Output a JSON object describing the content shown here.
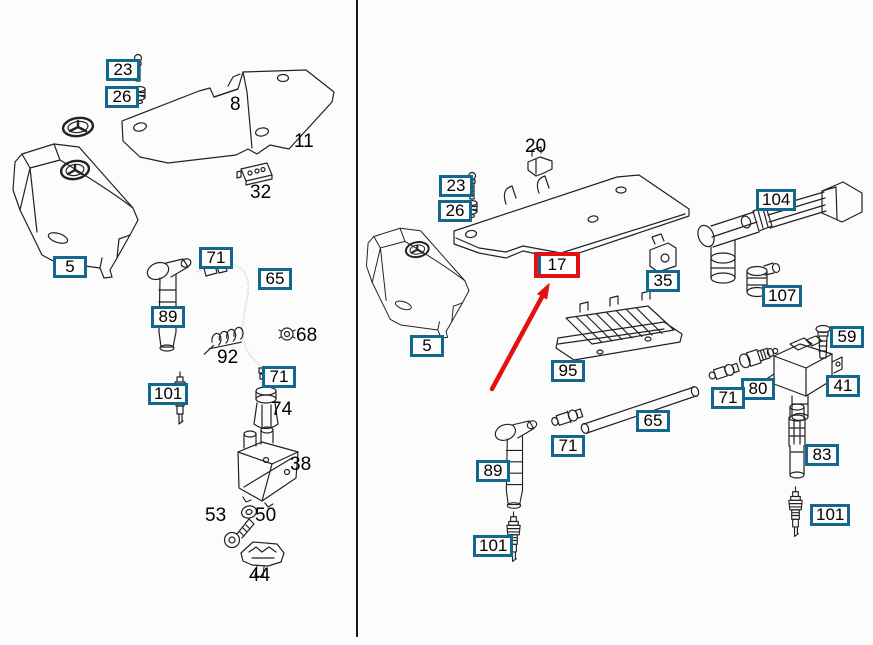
{
  "colors": {
    "page_bg": "#fcfcfc",
    "box_border": "#12688f",
    "highlight_border": "#e31212",
    "arrow": "#e31212",
    "ink": "#222222",
    "divider": "#1a1a1a"
  },
  "diagram": {
    "kind": "engine-ignition-parts-diagram",
    "highlighted_part": "17",
    "panel_count": 2
  },
  "labels_left": [
    {
      "text": "23",
      "style": "boxed"
    },
    {
      "text": "26",
      "style": "boxed"
    },
    {
      "text": "8",
      "style": "plain"
    },
    {
      "text": "11",
      "style": "plain"
    },
    {
      "text": "32",
      "style": "plain"
    },
    {
      "text": "5",
      "style": "boxed"
    },
    {
      "text": "71",
      "style": "boxed"
    },
    {
      "text": "65",
      "style": "boxed"
    },
    {
      "text": "89",
      "style": "boxed"
    },
    {
      "text": "92",
      "style": "plain"
    },
    {
      "text": "68",
      "style": "plain"
    },
    {
      "text": "71",
      "style": "boxed"
    },
    {
      "text": "101",
      "style": "boxed"
    },
    {
      "text": "74",
      "style": "plain"
    },
    {
      "text": "38",
      "style": "plain"
    },
    {
      "text": "53",
      "style": "plain"
    },
    {
      "text": "50",
      "style": "plain"
    },
    {
      "text": "44",
      "style": "plain"
    }
  ],
  "labels_right": [
    {
      "text": "20",
      "style": "plain"
    },
    {
      "text": "23",
      "style": "boxed"
    },
    {
      "text": "26",
      "style": "boxed"
    },
    {
      "text": "17",
      "style": "highlight"
    },
    {
      "text": "35",
      "style": "boxed"
    },
    {
      "text": "104",
      "style": "boxed"
    },
    {
      "text": "107",
      "style": "boxed"
    },
    {
      "text": "5",
      "style": "boxed"
    },
    {
      "text": "95",
      "style": "boxed"
    },
    {
      "text": "59",
      "style": "boxed"
    },
    {
      "text": "41",
      "style": "boxed"
    },
    {
      "text": "80",
      "style": "boxed"
    },
    {
      "text": "71",
      "style": "boxed"
    },
    {
      "text": "65",
      "style": "boxed"
    },
    {
      "text": "71",
      "style": "boxed"
    },
    {
      "text": "89",
      "style": "boxed"
    },
    {
      "text": "101",
      "style": "boxed"
    },
    {
      "text": "83",
      "style": "boxed"
    },
    {
      "text": "101",
      "style": "boxed"
    }
  ]
}
